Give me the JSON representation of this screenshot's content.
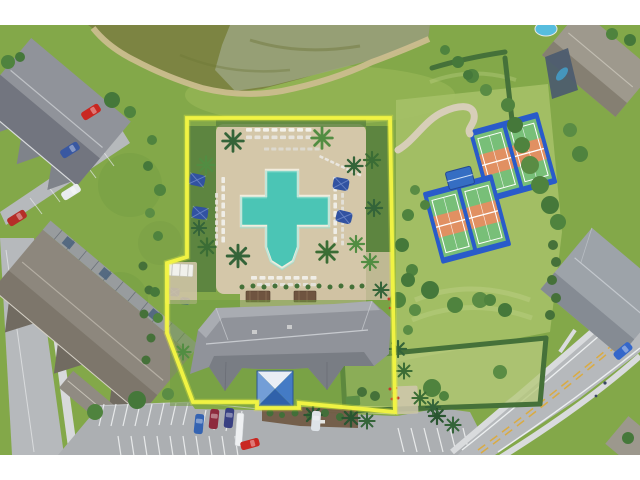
{
  "meta": {
    "type": "aerial-photograph",
    "description": "Drone aerial of a community amenity campus: cross-shaped resort pool with paver sun deck, clubhouse with blue pyramid entry canopy, four pickleball courts on two blue pads, pond, hedged dog run, parking lot with cars, surrounding condos and homes; a bright yellow boundary line outlines the amenity parcel.",
    "width": 640,
    "height": 480
  },
  "frame": {
    "bar_color": "#ffffff",
    "top_bar_height": 25,
    "bottom_bar_height": 25
  },
  "boundary": {
    "color": "#f2f43d",
    "underglow": "#e6ec2f",
    "stroke_width": 3.8,
    "points": "187,118 390,118 395,412 299,403 299,408 257,408 257,402 193,402 167,333 167,263 187,257"
  },
  "pool": {
    "water": "#46c4b3",
    "water_light": "#8fe0d4",
    "coping": "#f2ecdc",
    "path": "M266,170 L298,170 L298,196 L329,196 L329,226 L298,226 L298,247 L293,261 L282,268 L271,261 L266,247 L266,226 L241,226 L241,196 L266,196 Z"
  },
  "colors": {
    "grass": "#7fa644",
    "lawn_light": "#a3bf63",
    "lawn_pale": "#b4c878",
    "pond": "#78813c",
    "pond_algae": "#98a17a",
    "sand": "#cabb8b",
    "deck": "#d3c6a7",
    "paver": "#cfc1a0",
    "garden": "#567f3a",
    "road": "#b4b7ba",
    "asphalt": "#aaadb0",
    "sidewalk": "#d6d8da",
    "stripe": "#eef0f1",
    "road_yellow": "#d9a93c",
    "roof_gray": "#8d9097",
    "roof_dark": "#71747b",
    "roof_light": "#c7cacf",
    "roof_tan": "#8a8479",
    "roof_house": "#9b968a",
    "court_blue": "#2356c9",
    "court_border": "#17409e",
    "court_green": "#74bd74",
    "court_orange": "#e08d5d",
    "canopy_blue": "#2f6ac2",
    "canopy_light": "#e9eef5",
    "umbrella": "#2b4d9e",
    "hedge": "#3f6d33",
    "tree": "#4a7f38",
    "palm": "#2e5f33",
    "car_red": "#c8201a",
    "car_blue": "#2f5fb0",
    "car_navy": "#323a7e",
    "car_maroon": "#8a2437",
    "car_white": "#e9edf0",
    "cage": "#47566a",
    "small_pool": "#52bbdd"
  },
  "scene": {
    "features": [
      "pond",
      "cross-shaped-pool",
      "pool-deck",
      "clubhouse",
      "entry-canopy",
      "pickleball-courts",
      "dog-run",
      "parking-lot",
      "residences",
      "roads"
    ],
    "court_pad_count": 2,
    "court_count": 4,
    "pool_umbrella_count": 6
  }
}
